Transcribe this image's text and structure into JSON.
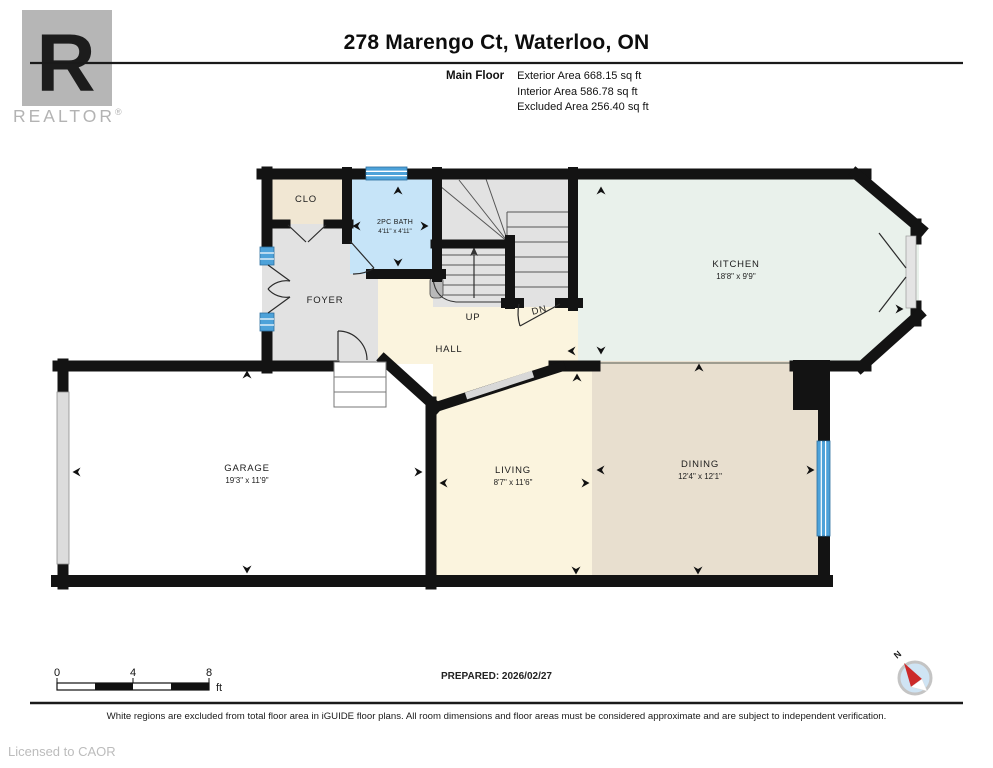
{
  "logo": {
    "letter": "R",
    "brand": "REALTOR",
    "reg": "®"
  },
  "header": {
    "title": "278 Marengo Ct, Waterloo, ON",
    "floor_label": "Main Floor",
    "area_lines": [
      "Exterior Area 668.15 sq ft",
      "Interior Area 586.78 sq ft",
      "Excluded Area 256.40 sq ft"
    ]
  },
  "rooms": {
    "clo": {
      "label": "CLO"
    },
    "bath": {
      "label": "2PC BATH",
      "dims": "4'11\" x 4'11\""
    },
    "foyer": {
      "label": "FOYER"
    },
    "hall": {
      "label": "HALL"
    },
    "kitchen": {
      "label": "KITCHEN",
      "dims": "18'8\" x 9'9\""
    },
    "garage": {
      "label": "GARAGE",
      "dims": "19'3\" x 11'9\""
    },
    "living": {
      "label": "LIVING",
      "dims": "8'7\" x 11'6\""
    },
    "dining": {
      "label": "DINING",
      "dims": "12'4\" x 12'1\""
    }
  },
  "stairs": {
    "up_label": "UP",
    "down_label": "DN"
  },
  "scale_bar": {
    "tick_0": "0",
    "tick_4": "4",
    "tick_8": "8",
    "unit": "ft"
  },
  "compass": {
    "north_label": "N"
  },
  "footer": {
    "prepared": "PREPARED: 2026/02/27",
    "disclaimer": "White regions are excluded from total floor area in iGUIDE floor plans. All room dimensions and floor areas must be considered approximate and are subject to independent verification.",
    "license": "Licensed to CAOR"
  },
  "colors": {
    "wall": "#131313",
    "bath_fill": "#c6e4f8",
    "window_blue": "#4da2d9",
    "kitchen_fill": "#e9f1eb",
    "hall_fill": "#fbf4de",
    "living_fill": "#fbf4de",
    "dining_fill": "#e8dfcf",
    "clo_fill": "#f1e7d3",
    "foyer_fill": "#e2e2e2",
    "glass_gray": "#dcdcdc",
    "compass_needle": "#cc2a2a"
  }
}
